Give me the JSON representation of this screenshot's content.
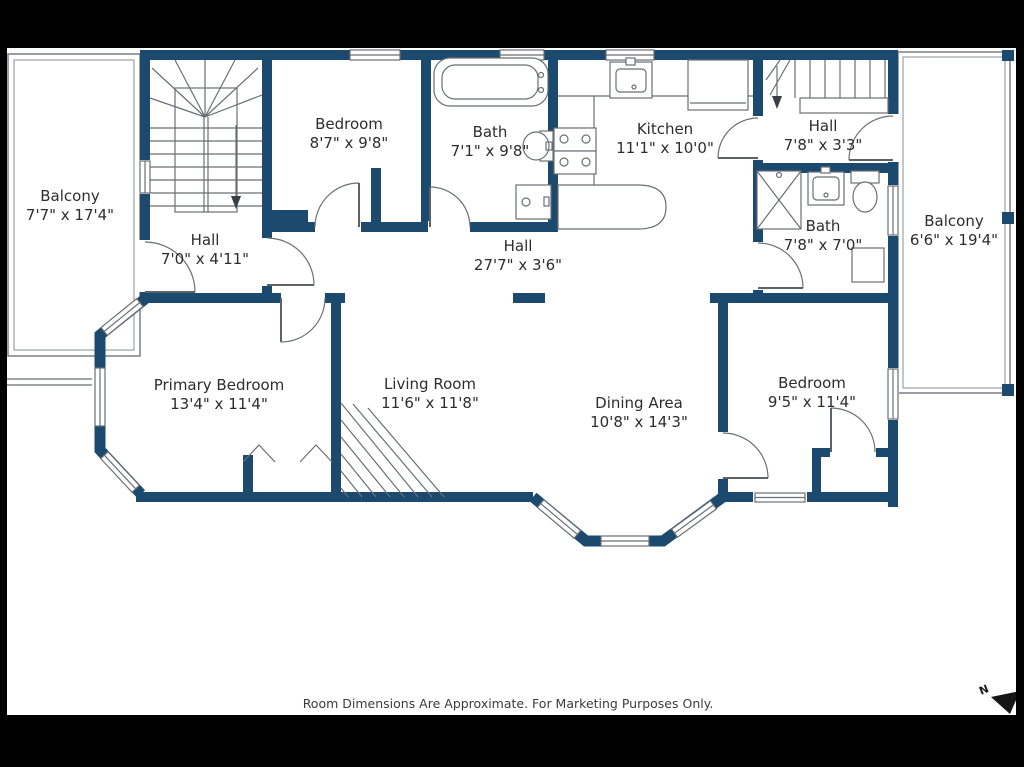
{
  "colors": {
    "wall": "#1b4a6e",
    "line": "#6a6f75",
    "text": "#2d2d2d",
    "frame": "#000000",
    "background": "#ffffff"
  },
  "rooms": [
    {
      "id": "balcony-left",
      "name": "Balcony",
      "dims": "7'7\" x 17'4\""
    },
    {
      "id": "hall-stairs",
      "name": "Hall",
      "dims": "7'0\" x 4'11\""
    },
    {
      "id": "bedroom-top",
      "name": "Bedroom",
      "dims": "8'7\" x 9'8\""
    },
    {
      "id": "bath-top",
      "name": "Bath",
      "dims": "7'1\" x 9'8\""
    },
    {
      "id": "kitchen",
      "name": "Kitchen",
      "dims": "11'1\" x 10'0\""
    },
    {
      "id": "hall-upper-right",
      "name": "Hall",
      "dims": "7'8\" x 3'3\""
    },
    {
      "id": "balcony-right",
      "name": "Balcony",
      "dims": "6'6\" x 19'4\""
    },
    {
      "id": "hall-center",
      "name": "Hall",
      "dims": "27'7\" x 3'6\""
    },
    {
      "id": "bath-right",
      "name": "Bath",
      "dims": "7'8\" x 7'0\""
    },
    {
      "id": "primary-bedroom",
      "name": "Primary Bedroom",
      "dims": "13'4\" x 11'4\""
    },
    {
      "id": "living-room",
      "name": "Living Room",
      "dims": "11'6\" x 11'8\""
    },
    {
      "id": "dining-area",
      "name": "Dining Area",
      "dims": "10'8\" x 14'3\""
    },
    {
      "id": "bedroom-right",
      "name": "Bedroom",
      "dims": "9'5\" x 11'4\""
    }
  ],
  "footer": {
    "text": "Room Dimensions Are Approximate. For Marketing Purposes Only."
  },
  "compass": {
    "label": "N"
  }
}
